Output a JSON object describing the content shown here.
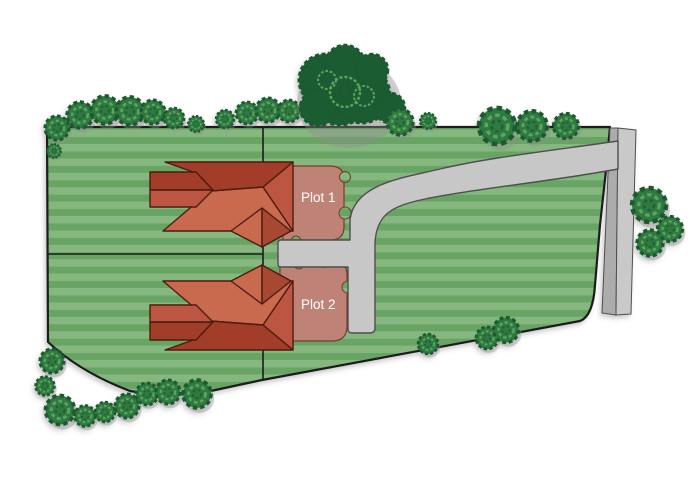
{
  "page": {
    "title": "Residential development site plan"
  },
  "plots": {
    "plot1_label": "Plot 1",
    "plot2_label": "Plot 2"
  },
  "colors": {
    "lawn_light": "#85b77f",
    "lawn_dark": "#67a464",
    "boundary": "#1c1c1c",
    "roof_dark": "#a23e2a",
    "roof_mid": "#bc5742",
    "roof_light": "#c96a50",
    "roof_gable": "#a84731",
    "roof_outline": "#4d1c10",
    "paving_pink": "#bf8276",
    "paving_pink_outline": "#7a3a2a",
    "driveway": "#c7c7c7",
    "driveway_outline": "#4f4f4f",
    "road_dark": "#acacac",
    "road_light": "#c9c9c9",
    "tree_dark": "#1d5a2f",
    "tree_body": "#2e7a41",
    "tree_ring": "#5ea362",
    "big_tree_body": "#1e5b30",
    "label_text": "#ffffff"
  }
}
